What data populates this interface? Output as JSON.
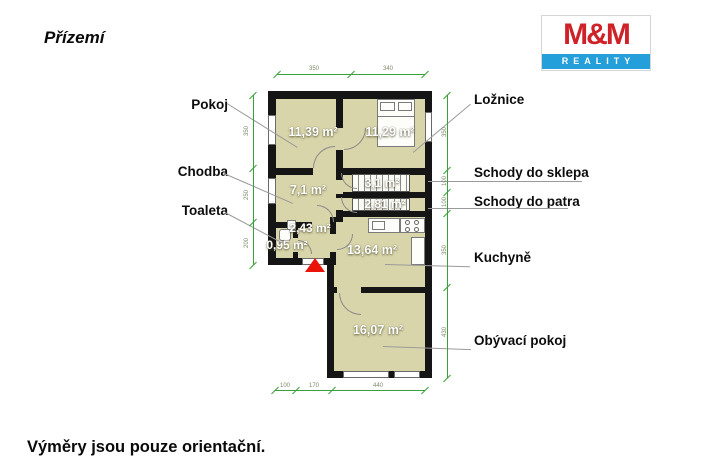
{
  "page": {
    "title": "Přízemí",
    "footnote": "Výměry jsou pouze orientační."
  },
  "logo": {
    "name": "M&M",
    "subtitle": "REALITY"
  },
  "room_labels": {
    "pokoj": "Pokoj",
    "chodba": "Chodba",
    "toaleta": "Toaleta",
    "loznice": "Ložnice",
    "schody_sklep": "Schody do sklepa",
    "schody_patro": "Schody do patra",
    "kuchyne": "Kuchyně",
    "obyvaci": "Obývací pokoj"
  },
  "areas": {
    "pokoj": "11,39 m²",
    "loznice": "11,29 m²",
    "chodba": "7,1 m²",
    "schody_sklep": "3,1 m²",
    "schody_patro": "2,81 m²",
    "predsin": "2,43 m²",
    "toaleta": "0,95 m²",
    "kuchyne": "13,64 m²",
    "obyvaci": "16,07 m²"
  },
  "dimensions": {
    "top": [
      "350",
      "340"
    ],
    "left": [
      "350",
      "250",
      "200"
    ],
    "right": [
      "350",
      "100",
      "100",
      "350",
      "430"
    ],
    "bottom": [
      "100",
      "170",
      "440"
    ]
  },
  "colors": {
    "room_fill": "#d9d5ab",
    "wall": "#151515",
    "dimension_green": "#3aa13a",
    "entry_arrow_red": "#ea1508",
    "logo_red": "#cf2228",
    "logo_blue": "#259fd9"
  }
}
